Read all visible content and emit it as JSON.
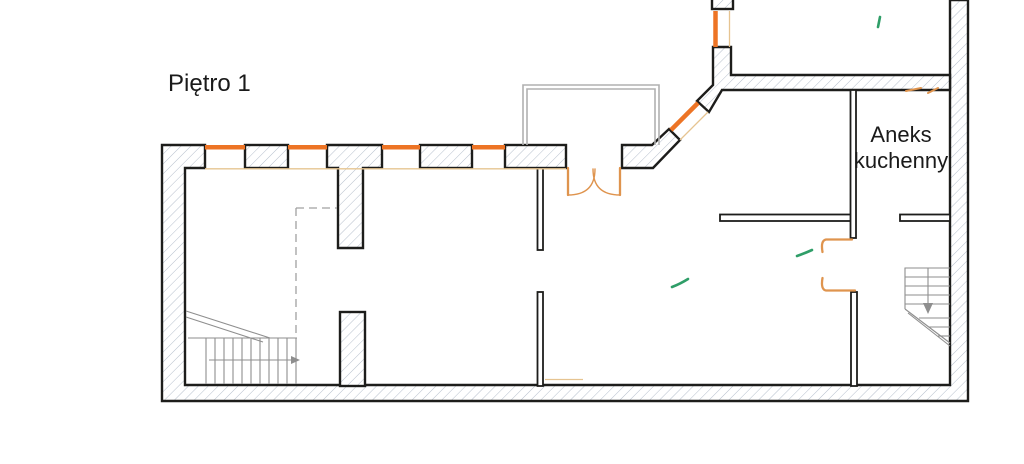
{
  "title": "Piętro 1",
  "room_label": {
    "line1": "Aneks",
    "line2": "kuchenny"
  },
  "colors": {
    "wall_outline": "#1d1d1b",
    "wall_hatch": "#b6bfcc",
    "window_orange": "#ed7425",
    "door_orange": "#df944e",
    "inner_face_tan": "#e6c491",
    "balcony_gray": "#b0b0b0",
    "stair_gray": "#8e8e8e",
    "dashed_gray": "#a0a0a0",
    "accent_green": "#2f9e68",
    "background": "#ffffff",
    "text": "#1a1a1a"
  }
}
